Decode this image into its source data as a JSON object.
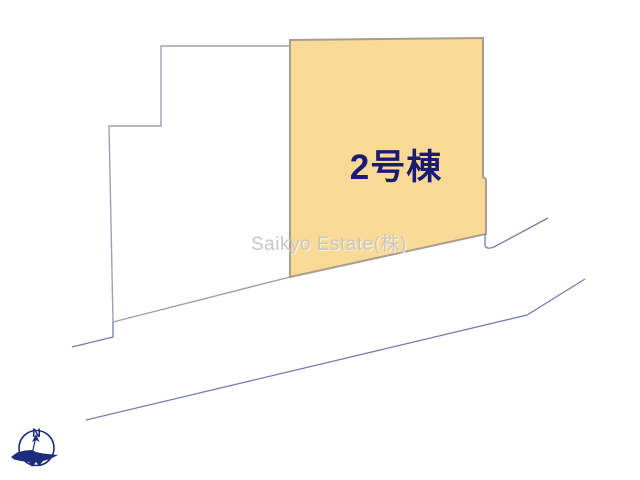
{
  "plan": {
    "building_label": "2号棟",
    "watermark": "Saikyo Estate(株)",
    "compass_north_label": "N"
  },
  "colors": {
    "parcel_fill": "#f8d996",
    "parcel_stroke": "#a89e8e",
    "adjacent_parcel_fill": "#ffffff",
    "adjacent_parcel_stroke": "#9ca0b5",
    "road_line": "#767cab",
    "building_label_color": "#1b1b70",
    "watermark_color": "#c9c7c2",
    "compass_color": "#1b2d7b"
  }
}
